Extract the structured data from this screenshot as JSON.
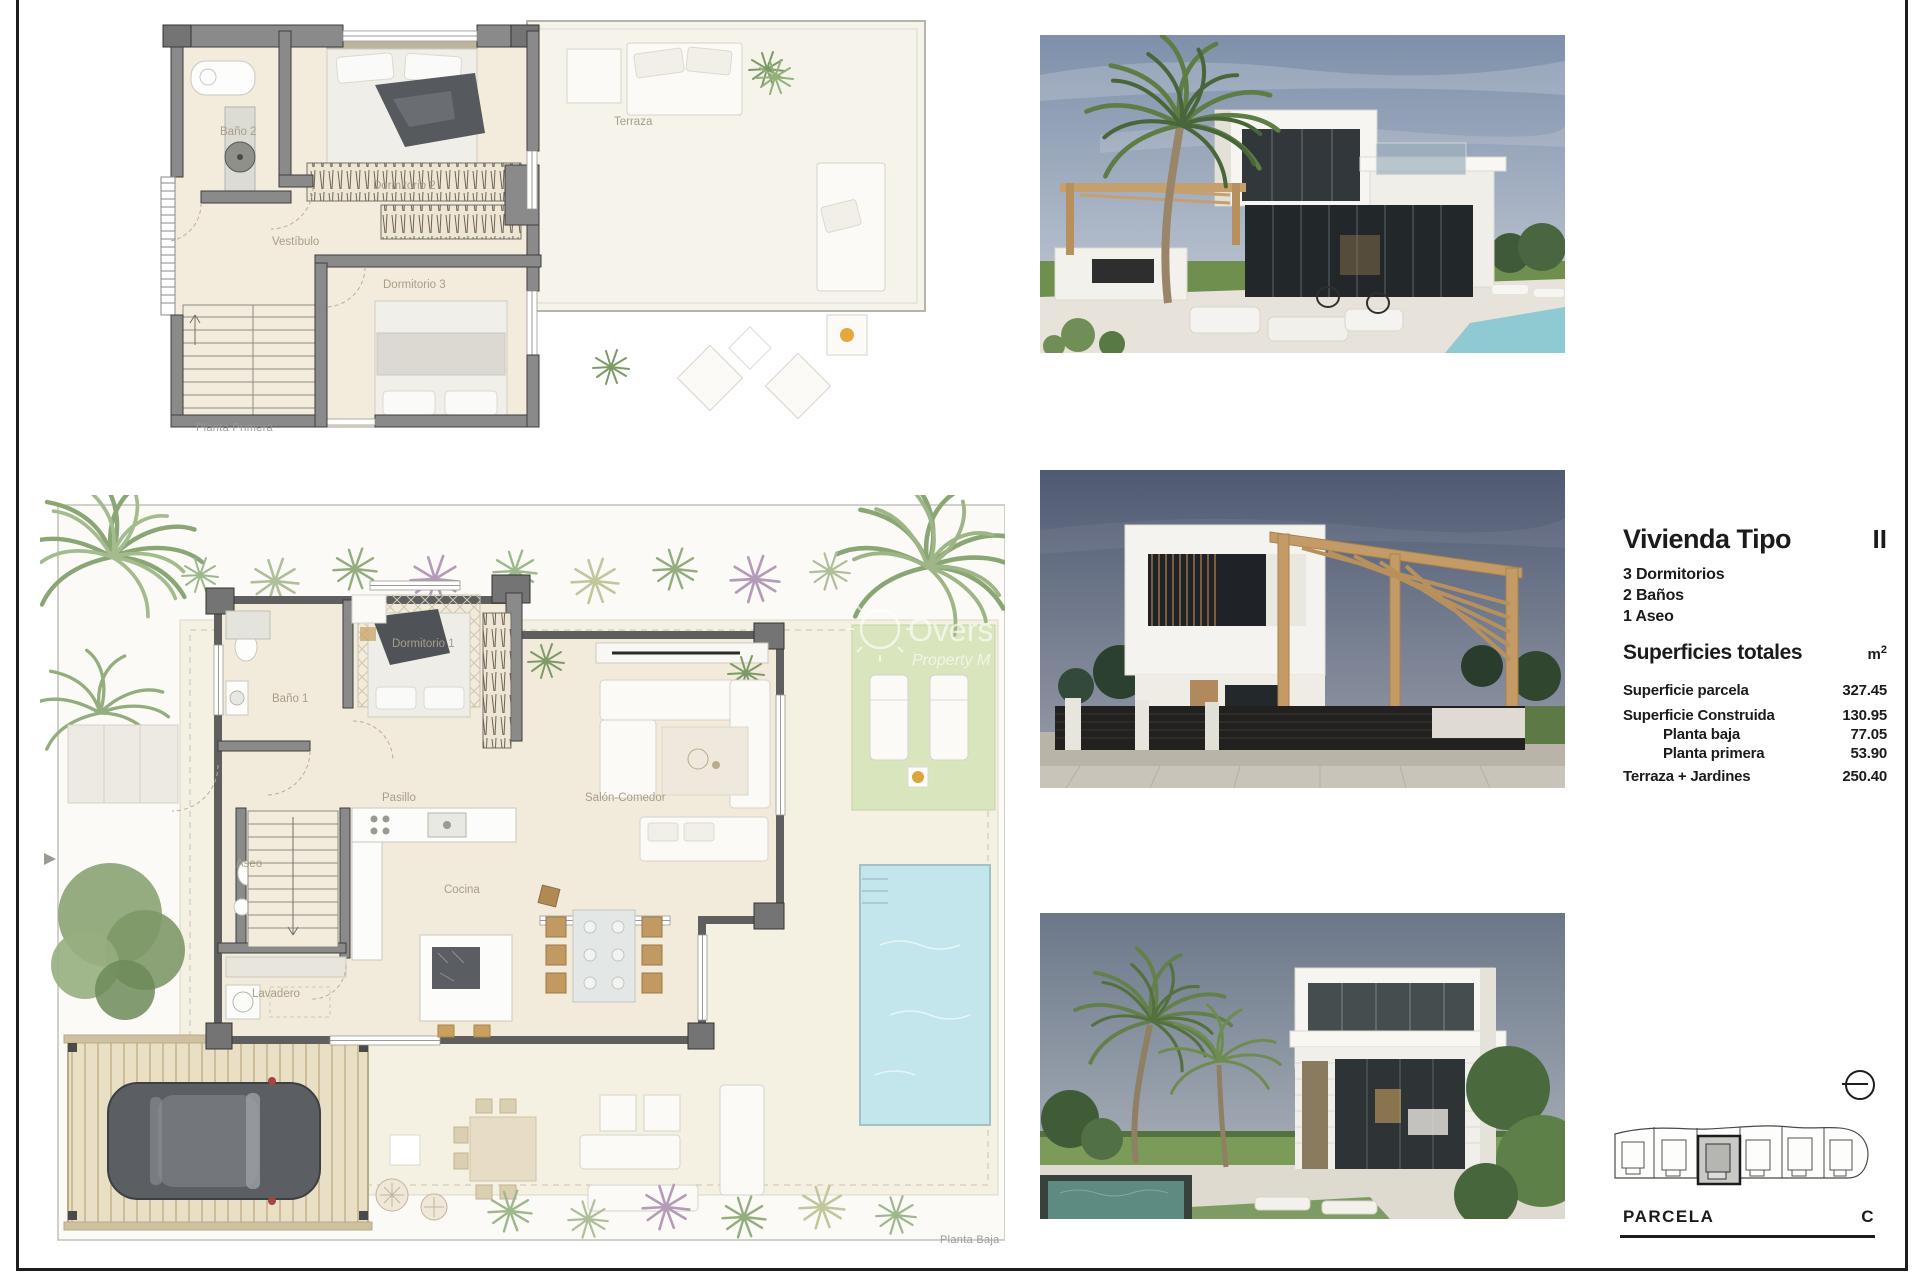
{
  "palette": {
    "accent": "#1b1b1b",
    "floor_beige": "#f2ebdb",
    "wall_gray": "#8a8a8a",
    "pool_blue": "#c2e6ec",
    "lawn_green": "#d9e5bc",
    "wood_tan": "#c69f6e"
  },
  "plans": {
    "planta_primera": {
      "caption": "Planta Primera",
      "rooms": {
        "bano2": "Baño 2",
        "dormitorio2": "Dormitorio 2",
        "dormitorio3": "Dormitorio 3",
        "vestibulo": "Vestíbulo",
        "terraza": "Terraza"
      }
    },
    "planta_baja": {
      "caption": "Planta Baja",
      "rooms": {
        "bano1": "Baño 1",
        "dormitorio1": "Dormitorio 1",
        "pasillo": "Pasillo",
        "aseo": "Aseo",
        "cocina": "Cocina",
        "lavadero": "Lavadero",
        "salon": "Salón-Comedor"
      }
    }
  },
  "watermark": {
    "line1": "Overs",
    "line2": "Property M"
  },
  "info": {
    "title": "Vivienda Tipo",
    "type_code": "II",
    "features": [
      "3 Dormitorios",
      "2 Baños",
      "1 Aseo"
    ],
    "surfaces_heading": "Superficies totales",
    "unit": "m",
    "unit_sup": "2",
    "rows": [
      {
        "label": "Superficie parcela",
        "value": "327.45"
      },
      {
        "label": "Superficie Construida",
        "value": "130.95"
      },
      {
        "label": "Planta baja",
        "value": "77.05"
      },
      {
        "label": "Planta primera",
        "value": "53.90"
      },
      {
        "label": "Terraza + Jardines",
        "value": "250.40"
      }
    ]
  },
  "parcela": {
    "label": "PARCELA",
    "code": "C"
  }
}
